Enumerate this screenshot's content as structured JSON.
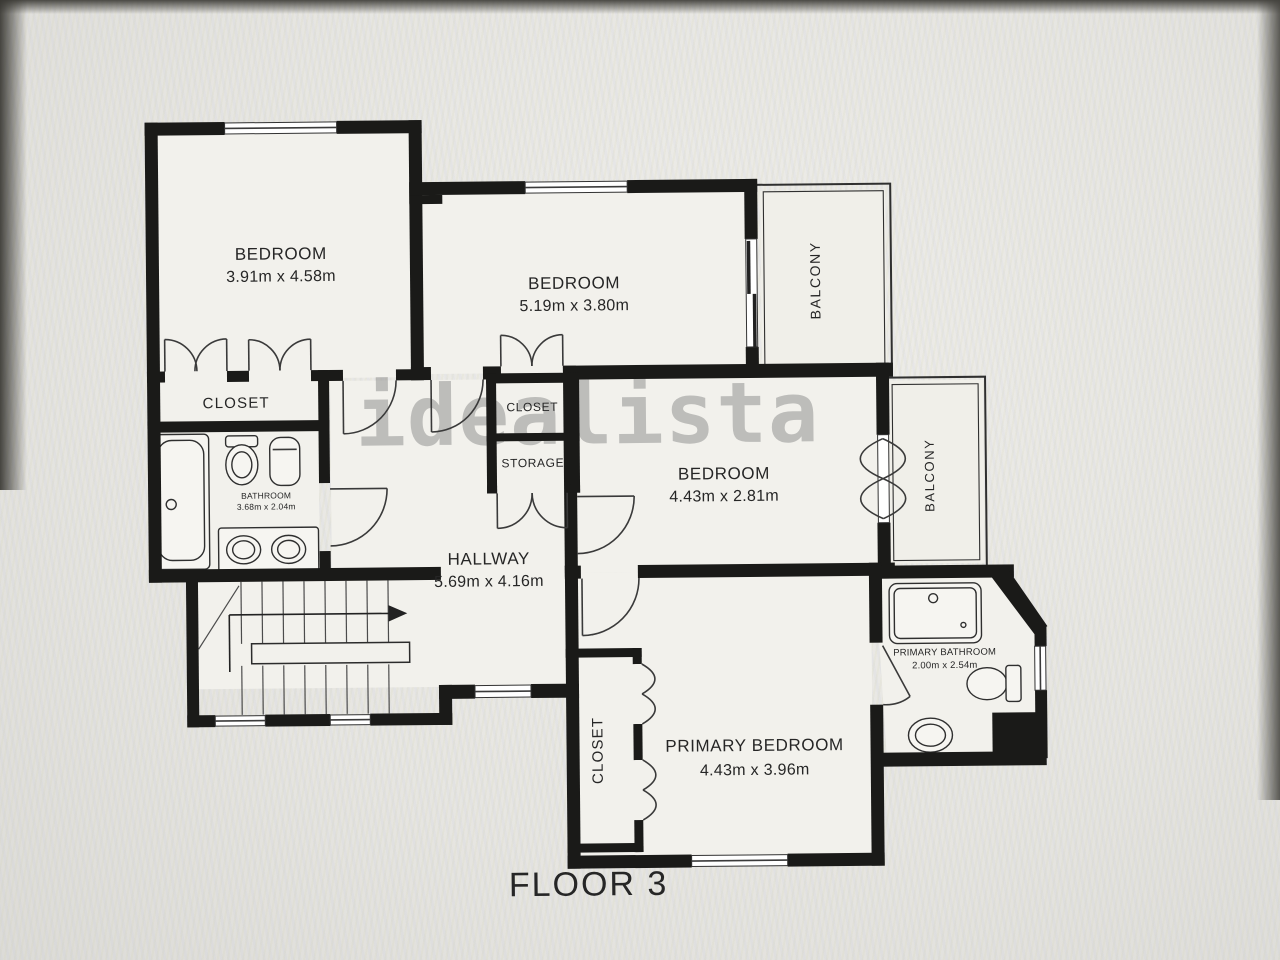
{
  "floor_plan": {
    "title": "FLOOR 3",
    "watermark": "idealista",
    "colors": {
      "wall": "#1a1a18",
      "room_fill": "#f2f1ec",
      "background": "#e8e7e3",
      "watermark_gray": "#8a8a8a"
    },
    "rooms": {
      "bedroom_top_left": {
        "name": "BEDROOM",
        "dims": "3.91m x 4.58m"
      },
      "bedroom_top_middle": {
        "name": "BEDROOM",
        "dims": "5.19m x 3.80m"
      },
      "bedroom_middle_right": {
        "name": "BEDROOM",
        "dims": "4.43m x 2.81m"
      },
      "primary_bedroom": {
        "name": "PRIMARY BEDROOM",
        "dims": "4.43m x 3.96m"
      },
      "hallway": {
        "name": "HALLWAY",
        "dims": "5.69m x 4.16m"
      },
      "bathroom": {
        "name": "BATHROOM",
        "dims": "3.68m x 2.04m"
      },
      "primary_bathroom": {
        "name": "PRIMARY BATHROOM",
        "dims": "2.00m x 2.54m"
      },
      "closet_bedroom1": {
        "name": "CLOSET"
      },
      "closet_hall": {
        "name": "CLOSET"
      },
      "storage": {
        "name": "STORAGE"
      },
      "closet_primary": {
        "name": "CLOSET"
      },
      "balcony_top": {
        "name": "BALCONY"
      },
      "balcony_right": {
        "name": "BALCONY"
      }
    }
  }
}
